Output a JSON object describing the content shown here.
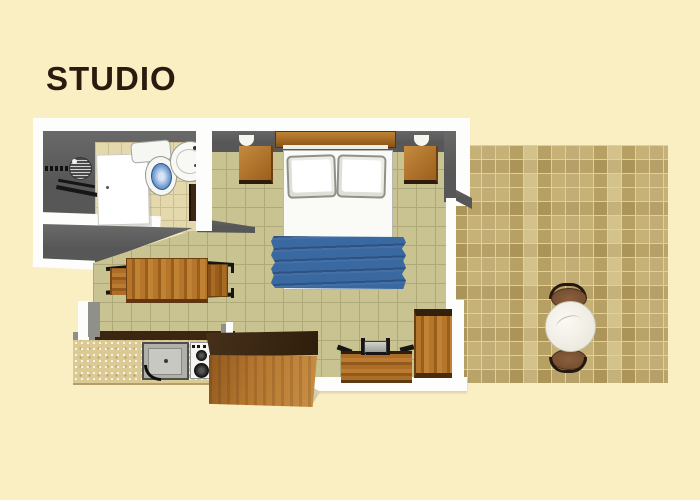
{
  "page": {
    "background_color": "#FAEFC3",
    "title": "STUDIO",
    "title_color": "#2B1A0E"
  },
  "floorplan": {
    "rooms": [
      {
        "name": "bathroom",
        "features": [
          "shower-head",
          "shower-handle",
          "towel-rails",
          "bathroom-door",
          "toilet",
          "washbasin",
          "entry-door"
        ]
      },
      {
        "name": "main-room",
        "features": [
          "double-bed",
          "headboard",
          "pillow-left",
          "pillow-right",
          "blue-blanket",
          "nightstand-left",
          "nightstand-right",
          "wall-lamp-left",
          "wall-lamp-right",
          "dining-table",
          "dining-chair-left",
          "dining-chair-right",
          "desk",
          "tv-stand",
          "tall-cabinet"
        ]
      },
      {
        "name": "kitchenette",
        "features": [
          "counter",
          "kitchen-sink",
          "stove",
          "island-cabinet"
        ]
      },
      {
        "name": "terrace",
        "features": [
          "round-table",
          "terrace-chair-top",
          "terrace-chair-bottom"
        ]
      }
    ],
    "palette": {
      "wall_dark": "#5C5C5C",
      "wall_outline": "#FDFDFB",
      "bathroom_tile": "#E4D9AD",
      "room_tile": "#C8C390",
      "terrace_tile": "#C6B176",
      "wood": "#A96C28",
      "wood_dark": "#3B2711",
      "counter_face": "#DCCA94",
      "blanket_blue": "#3A68A0",
      "toilet_bowl_blue": "#5D8CC8"
    }
  }
}
